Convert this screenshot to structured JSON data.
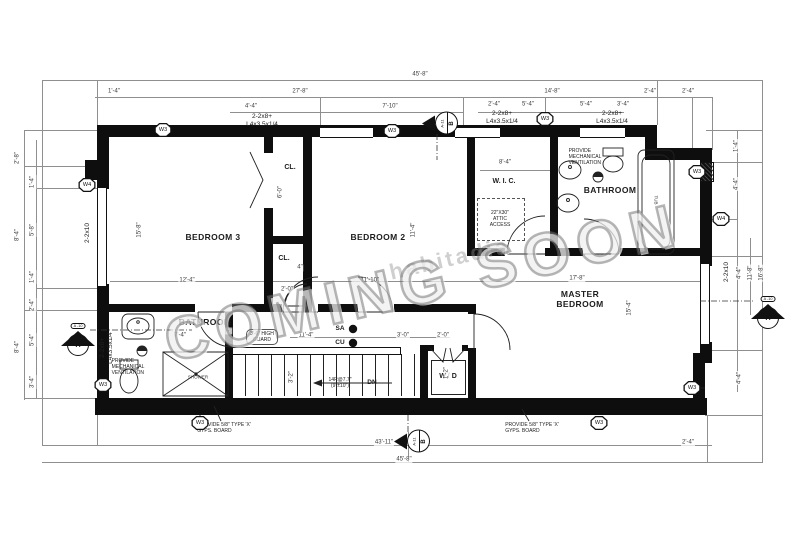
{
  "title": "Second floor framing plan",
  "watermark": {
    "text": "COMING SOON",
    "subtext": "habitadia"
  },
  "labels": [
    {
      "name": "room-label-bedroom3",
      "cls": "room",
      "text": "BEDROOM 3",
      "x": 213,
      "y": 237
    },
    {
      "name": "room-label-bedroom2",
      "cls": "room",
      "text": "BEDROOM 2",
      "x": 378,
      "y": 237
    },
    {
      "name": "room-label-master-bedroom",
      "cls": "room",
      "text": "MASTER\nBEDROOM",
      "x": 580,
      "y": 299
    },
    {
      "name": "room-label-bathroom-left",
      "cls": "room",
      "text": "BATHROOM",
      "x": 205,
      "y": 322
    },
    {
      "name": "room-label-bathroom-right",
      "cls": "room",
      "text": "BATHROOM",
      "x": 610,
      "y": 190
    },
    {
      "name": "room-label-wic",
      "cls": "room-sm",
      "text": "W. I. C.",
      "x": 504,
      "y": 182
    },
    {
      "name": "room-label-closet-top",
      "cls": "room-sm",
      "text": "CL.",
      "x": 290,
      "y": 168
    },
    {
      "name": "room-label-closet-bottom",
      "cls": "room-sm",
      "text": "CL.",
      "x": 284,
      "y": 259
    },
    {
      "name": "room-label-washer-dryer",
      "cls": "room-sm",
      "text": "W / D",
      "x": 448,
      "y": 377
    },
    {
      "name": "fixture-label-tub",
      "cls": "tiny",
      "text": "TUB",
      "x": 656,
      "y": 200,
      "rot": 90
    },
    {
      "name": "fixture-label-shower",
      "cls": "tiny",
      "text": "SHOWER",
      "x": 198,
      "y": 377
    },
    {
      "name": "note-attic-access",
      "cls": "note",
      "text": "22\"X30\"\nATTIC\nACCESS",
      "x": 500,
      "y": 219
    },
    {
      "name": "note-mech-vent-left",
      "cls": "note-l",
      "text": "PROVIDE\nMECHANICAL\nVENTILATION",
      "x": 128,
      "y": 367
    },
    {
      "name": "note-mech-vent-right",
      "cls": "note-l",
      "text": "PROVIDE\nMECHANICAL\nVENTILATION",
      "x": 585,
      "y": 157
    },
    {
      "name": "note-gyps-board-left",
      "cls": "note-l",
      "text": "PROVIDE 5/8\" TYPE 'X'\nGYPS. BOARD",
      "x": 224,
      "y": 428
    },
    {
      "name": "note-gyps-board-right",
      "cls": "note-l",
      "text": "PROVIDE 5/8\" TYPE 'X'\nGYPS. BOARD",
      "x": 532,
      "y": 428
    },
    {
      "name": "note-guard",
      "cls": "pill lbl-pill",
      "text": "3'-6\" HIGH\nGUARD",
      "x": 262,
      "y": 337
    },
    {
      "name": "note-stair-risers",
      "cls": "note",
      "text": "14R@7.7\"\n(9\"±10\")",
      "x": 340,
      "y": 383
    },
    {
      "name": "label-down",
      "cls": "bold-tiny",
      "text": "DN",
      "x": 372,
      "y": 383
    },
    {
      "name": "label-smoke-alarm",
      "cls": "bold-tiny",
      "text": "SA",
      "x": 340,
      "y": 329
    },
    {
      "name": "label-co-detector",
      "cls": "bold-tiny",
      "text": "CU",
      "x": 340,
      "y": 343
    },
    {
      "name": "beam-label-1",
      "cls": "beam",
      "text": "2-2x8+\nL4x3.5x1/4",
      "x": 262,
      "y": 121
    },
    {
      "name": "beam-label-2",
      "cls": "beam",
      "text": "2-2x8+\nL4x3.5x1/4",
      "x": 502,
      "y": 118
    },
    {
      "name": "beam-label-3",
      "cls": "beam",
      "text": "2-2x8+\nL4x3.5x1/4",
      "x": 612,
      "y": 118
    },
    {
      "name": "beam-label-4",
      "cls": "beam",
      "text": "2-2x8+\nL4x3.5x1/4",
      "x": 107,
      "y": 348,
      "rot": -90
    },
    {
      "name": "joist-label-left",
      "cls": "beam",
      "text": "2-2x10",
      "x": 88,
      "y": 233,
      "rot": -90
    },
    {
      "name": "joist-label-right",
      "cls": "beam",
      "text": "2-2x10",
      "x": 727,
      "y": 272,
      "rot": -90
    },
    {
      "cls": "dim",
      "text": "45'-8\"",
      "x": 420,
      "y": 75
    },
    {
      "cls": "dim",
      "text": "1'-4\"",
      "x": 114,
      "y": 92
    },
    {
      "cls": "dim",
      "text": "27'-8\"",
      "x": 300,
      "y": 92
    },
    {
      "cls": "dim",
      "text": "14'-8\"",
      "x": 552,
      "y": 92
    },
    {
      "cls": "dim",
      "text": "2'-4\"",
      "x": 650,
      "y": 92
    },
    {
      "cls": "dim",
      "text": "2'-4\"",
      "x": 688,
      "y": 92
    },
    {
      "cls": "dim",
      "text": "4'-4\"",
      "x": 251,
      "y": 107
    },
    {
      "cls": "dim",
      "text": "7'-10\"",
      "x": 390,
      "y": 107
    },
    {
      "cls": "dim",
      "text": "2'-4\"",
      "x": 494,
      "y": 105
    },
    {
      "cls": "dim",
      "text": "5'-4\"",
      "x": 528,
      "y": 105
    },
    {
      "cls": "dim",
      "text": "5'-4\"",
      "x": 586,
      "y": 105
    },
    {
      "cls": "dim",
      "text": "3'-4\"",
      "x": 623,
      "y": 105
    },
    {
      "cls": "dim",
      "text": "8'-4\"",
      "x": 505,
      "y": 163
    },
    {
      "cls": "dim",
      "text": "12'-4\"",
      "x": 187,
      "y": 281
    },
    {
      "cls": "dim",
      "text": "11'-10\"",
      "x": 370,
      "y": 281
    },
    {
      "cls": "dim",
      "text": "17'-8\"",
      "x": 577,
      "y": 279
    },
    {
      "cls": "dim",
      "text": "2'-0\"",
      "x": 287,
      "y": 290
    },
    {
      "cls": "dim",
      "text": "4\"",
      "x": 300,
      "y": 268
    },
    {
      "cls": "dim",
      "text": "6'-0\"",
      "x": 281,
      "y": 192,
      "rot": -90
    },
    {
      "cls": "dim",
      "text": "15'-8\"",
      "x": 140,
      "y": 230,
      "rot": -90
    },
    {
      "cls": "dim",
      "text": "11'-4\"",
      "x": 414,
      "y": 230,
      "rot": -90
    },
    {
      "cls": "dim",
      "text": "15'-4\"",
      "x": 630,
      "y": 308,
      "rot": -90
    },
    {
      "cls": "dim",
      "text": "7'-4\"",
      "x": 180,
      "y": 336
    },
    {
      "cls": "dim",
      "text": "4\"",
      "x": 229,
      "y": 331
    },
    {
      "cls": "dim",
      "text": "11'-4\"",
      "x": 306,
      "y": 336
    },
    {
      "cls": "dim",
      "text": "3'-0\"",
      "x": 403,
      "y": 336
    },
    {
      "cls": "dim",
      "text": "2'-0\"",
      "x": 443,
      "y": 336
    },
    {
      "cls": "dim",
      "text": "3'-2\"",
      "x": 292,
      "y": 377,
      "rot": -90
    },
    {
      "cls": "dim",
      "text": "1'-2\"",
      "x": 447,
      "y": 373,
      "rot": -90
    },
    {
      "cls": "dim",
      "text": "1'-4\"",
      "x": 737,
      "y": 146,
      "rot": -90
    },
    {
      "cls": "dim",
      "text": "4'-4\"",
      "x": 737,
      "y": 184,
      "rot": -90
    },
    {
      "cls": "dim",
      "text": "4'-4\"",
      "x": 740,
      "y": 273,
      "rot": -90
    },
    {
      "cls": "dim",
      "text": "11'-8\"",
      "x": 751,
      "y": 273,
      "rot": -90
    },
    {
      "cls": "dim",
      "text": "16'-8\"",
      "x": 762,
      "y": 273,
      "rot": -90
    },
    {
      "cls": "dim",
      "text": "4'-4\"",
      "x": 740,
      "y": 378,
      "rot": -90
    },
    {
      "cls": "dim",
      "text": "2'-4\"",
      "x": 688,
      "y": 443
    },
    {
      "cls": "dim",
      "text": "43'-11\"",
      "x": 384,
      "y": 443
    },
    {
      "cls": "dim",
      "text": "45'-8\"",
      "x": 404,
      "y": 460
    },
    {
      "cls": "dim",
      "text": "2'-8\"",
      "x": 18,
      "y": 158,
      "rot": -90
    },
    {
      "cls": "dim",
      "text": "8'-4\"",
      "x": 18,
      "y": 235,
      "rot": -90
    },
    {
      "cls": "dim",
      "text": "8'-4\"",
      "x": 18,
      "y": 347,
      "rot": -90
    },
    {
      "cls": "dim",
      "text": "1'-4\"",
      "x": 33,
      "y": 182,
      "rot": -90
    },
    {
      "cls": "dim",
      "text": "5'-8\"",
      "x": 33,
      "y": 230,
      "rot": -90
    },
    {
      "cls": "dim",
      "text": "1'-4\"",
      "x": 33,
      "y": 277,
      "rot": -90
    },
    {
      "cls": "dim",
      "text": "2'-4\"",
      "x": 33,
      "y": 305,
      "rot": -90
    },
    {
      "cls": "dim",
      "text": "5'-4\"",
      "x": 33,
      "y": 340,
      "rot": -90
    },
    {
      "cls": "dim",
      "text": "3'-4\"",
      "x": 33,
      "y": 382,
      "rot": -90
    }
  ],
  "wall_markers": [
    {
      "label": "W3",
      "x": 163,
      "y": 130
    },
    {
      "label": "W3",
      "x": 392,
      "y": 131
    },
    {
      "label": "W3",
      "x": 545,
      "y": 119
    },
    {
      "label": "W3",
      "x": 697,
      "y": 172
    },
    {
      "label": "W4",
      "x": 721,
      "y": 219
    },
    {
      "label": "W4",
      "x": 87,
      "y": 185
    },
    {
      "label": "W3",
      "x": 103,
      "y": 385
    },
    {
      "label": "W3",
      "x": 200,
      "y": 423
    },
    {
      "label": "W3",
      "x": 599,
      "y": 423
    },
    {
      "label": "W3",
      "x": 692,
      "y": 388
    }
  ],
  "section_markers": [
    {
      "type": "side",
      "top": "A-11",
      "bottom": "B",
      "x": 440,
      "y": 123
    },
    {
      "type": "side",
      "top": "A-11",
      "bottom": "B",
      "x": 412,
      "y": 441
    },
    {
      "type": "up",
      "pill": "A -10",
      "circle": "A",
      "x": 78,
      "y": 314
    },
    {
      "type": "up",
      "pill": "A -10",
      "circle": "A",
      "x": 768,
      "y": 287
    }
  ],
  "dim_lines": [
    {
      "x": 42,
      "y": 80,
      "w": 721
    },
    {
      "x": 95,
      "y": 97,
      "w": 617
    },
    {
      "x": 230,
      "y": 112,
      "w": 233
    },
    {
      "x": 478,
      "y": 112,
      "w": 146
    },
    {
      "x": 42,
      "y": 445,
      "w": 670
    },
    {
      "x": 42,
      "y": 462,
      "w": 721
    },
    {
      "x": 110,
      "y": 281,
      "w": 597
    },
    {
      "x": 290,
      "y": 337,
      "w": 160
    },
    {
      "x": 480,
      "y": 170,
      "w": 70
    },
    {
      "x": 42,
      "y": 80,
      "h": 365
    },
    {
      "x": 24,
      "y": 130,
      "h": 270
    },
    {
      "x": 36,
      "y": 140,
      "h": 258
    },
    {
      "x": 737,
      "y": 130,
      "h": 262
    },
    {
      "x": 750,
      "y": 238,
      "h": 77
    },
    {
      "x": 762,
      "y": 80,
      "h": 382
    },
    {
      "x": 97,
      "y": 80,
      "h": 45
    },
    {
      "x": 463,
      "y": 97,
      "h": 40
    },
    {
      "x": 657,
      "y": 80,
      "h": 45
    },
    {
      "x": 692,
      "y": 97,
      "h": 63
    },
    {
      "x": 712,
      "y": 97,
      "h": 53
    },
    {
      "x": 545,
      "y": 97,
      "h": 22
    },
    {
      "x": 320,
      "y": 97,
      "h": 28
    },
    {
      "x": 97,
      "y": 415,
      "h": 30
    },
    {
      "x": 408,
      "y": 432,
      "h": 30
    },
    {
      "x": 707,
      "y": 415,
      "h": 47
    },
    {
      "x": 706,
      "y": 130,
      "w": 57
    },
    {
      "x": 712,
      "y": 162,
      "w": 50
    },
    {
      "x": 706,
      "y": 256,
      "w": 56
    },
    {
      "x": 700,
      "y": 350,
      "w": 62
    },
    {
      "x": 705,
      "y": 415,
      "w": 58
    },
    {
      "x": 712,
      "y": 219,
      "w": 25
    },
    {
      "x": 24,
      "y": 130,
      "w": 73
    },
    {
      "x": 24,
      "y": 166,
      "w": 61
    },
    {
      "x": 24,
      "y": 310,
      "w": 73
    },
    {
      "x": 24,
      "y": 398,
      "w": 73
    },
    {
      "x": 36,
      "y": 188,
      "w": 61
    },
    {
      "x": 36,
      "y": 288,
      "w": 61
    }
  ],
  "walls": [
    [
      97,
      125,
      560,
      12
    ],
    [
      645,
      137,
      12,
      14
    ],
    [
      645,
      148,
      67,
      12
    ],
    [
      700,
      160,
      12,
      92
    ],
    [
      700,
      252,
      12,
      14
    ],
    [
      700,
      342,
      12,
      14
    ],
    [
      693,
      353,
      19,
      10
    ],
    [
      693,
      360,
      12,
      55
    ],
    [
      95,
      398,
      612,
      17
    ],
    [
      97,
      125,
      12,
      64
    ],
    [
      85,
      160,
      24,
      20
    ],
    [
      97,
      284,
      12,
      116
    ],
    [
      264,
      137,
      9,
      16
    ],
    [
      264,
      208,
      9,
      36
    ],
    [
      264,
      236,
      48,
      8
    ],
    [
      264,
      244,
      9,
      68
    ],
    [
      303,
      137,
      9,
      175
    ],
    [
      97,
      304,
      98,
      8
    ],
    [
      232,
      304,
      50,
      8
    ],
    [
      318,
      304,
      40,
      8
    ],
    [
      394,
      304,
      76,
      8
    ],
    [
      467,
      137,
      8,
      119
    ],
    [
      550,
      137,
      8,
      117
    ],
    [
      467,
      248,
      38,
      8
    ],
    [
      545,
      248,
      38,
      8
    ],
    [
      620,
      248,
      92,
      8
    ],
    [
      468,
      304,
      8,
      10
    ],
    [
      468,
      348,
      8,
      50
    ],
    [
      420,
      345,
      8,
      53
    ],
    [
      428,
      345,
      6,
      6
    ],
    [
      462,
      345,
      6,
      6
    ],
    [
      225,
      312,
      8,
      86
    ]
  ],
  "windows_v": [
    [
      97,
      188,
      8,
      98
    ],
    [
      700,
      264,
      8,
      80
    ]
  ],
  "windows_h": [
    [
      320,
      127,
      53,
      9
    ],
    [
      455,
      127,
      45,
      9
    ],
    [
      580,
      127,
      45,
      9
    ]
  ],
  "hatches": [
    [
      700,
      162,
      12,
      18
    ]
  ]
}
